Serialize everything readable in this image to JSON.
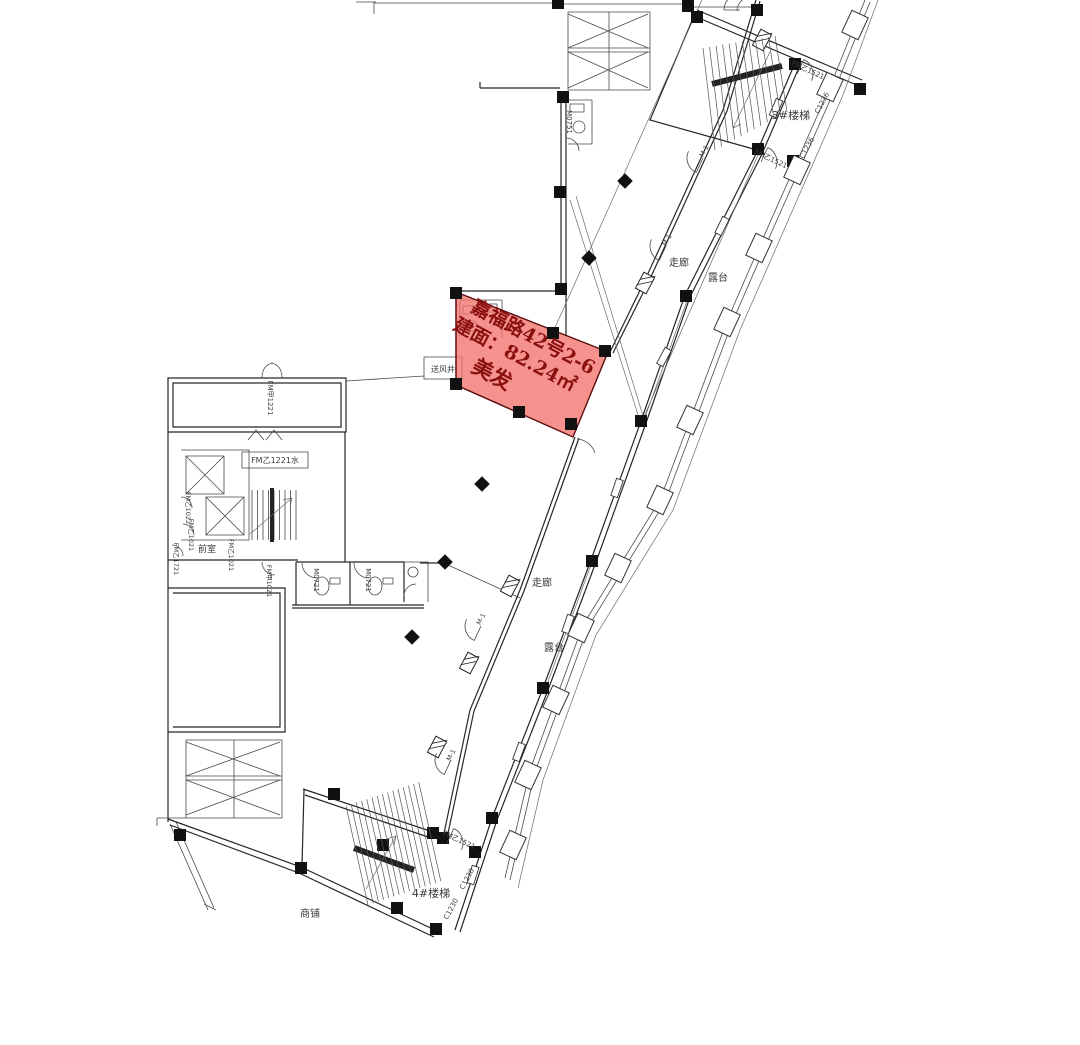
{
  "unit": {
    "address": "嘉福路42号2-6",
    "area_label": "建面：82.24㎡",
    "category": "美发",
    "fill": "#f3736e",
    "text_color": "#8a0f0f"
  },
  "labels": [
    {
      "text": "3#楼梯",
      "x": 791,
      "y": 119,
      "rot": 0,
      "size": 11
    },
    {
      "text": "4#楼梯",
      "x": 431,
      "y": 897,
      "rot": 0,
      "size": 11
    },
    {
      "text": "走廊",
      "x": 679,
      "y": 266,
      "rot": 0,
      "size": 10
    },
    {
      "text": "露台",
      "x": 718,
      "y": 281,
      "rot": 0,
      "size": 10
    },
    {
      "text": "走廊",
      "x": 542,
      "y": 586,
      "rot": 0,
      "size": 10
    },
    {
      "text": "露台",
      "x": 554,
      "y": 651,
      "rot": 0,
      "size": 10
    },
    {
      "text": "商铺",
      "x": 310,
      "y": 917,
      "rot": 0,
      "size": 10
    },
    {
      "text": "前室",
      "x": 207,
      "y": 552,
      "rot": 0,
      "size": 9
    },
    {
      "text": "送风井",
      "x": 443,
      "y": 372,
      "rot": 0,
      "size": 8
    },
    {
      "text": "FM乙1221水",
      "x": 275,
      "y": 463,
      "rot": 0,
      "size": 8
    },
    {
      "text": "FM甲1221",
      "x": 268,
      "y": 398,
      "rot": 90,
      "size": 7
    },
    {
      "text": "M0751",
      "x": 567,
      "y": 122,
      "rot": 90,
      "size": 7
    },
    {
      "text": "M0721",
      "x": 314,
      "y": 580,
      "rot": 90,
      "size": 7
    },
    {
      "text": "M0721",
      "x": 366,
      "y": 580,
      "rot": 90,
      "size": 7
    },
    {
      "text": "FM乙1022",
      "x": 186,
      "y": 508,
      "rot": 90,
      "size": 6.5
    },
    {
      "text": "FM乙1021",
      "x": 189,
      "y": 535,
      "rot": 90,
      "size": 6.5
    },
    {
      "text": "FM乙1721",
      "x": 174,
      "y": 559,
      "rot": 90,
      "size": 6.5
    },
    {
      "text": "FM乙1021",
      "x": 229,
      "y": 555,
      "rot": 90,
      "size": 6.5
    },
    {
      "text": "FM甲1021",
      "x": 267,
      "y": 581,
      "rot": 90,
      "size": 6.5
    },
    {
      "text": "FM乙1521",
      "x": 807,
      "y": 72,
      "rot": 25,
      "size": 7
    },
    {
      "text": "FM乙1521",
      "x": 770,
      "y": 161,
      "rot": 25,
      "size": 7
    },
    {
      "text": "FM乙1521",
      "x": 458,
      "y": 842,
      "rot": 25,
      "size": 7
    },
    {
      "text": "C1236",
      "x": 824,
      "y": 104,
      "rot": -62,
      "size": 7
    },
    {
      "text": "C1236",
      "x": 809,
      "y": 149,
      "rot": -62,
      "size": 7
    },
    {
      "text": "C1230",
      "x": 469,
      "y": 880,
      "rot": -62,
      "size": 7
    },
    {
      "text": "C1230",
      "x": 453,
      "y": 910,
      "rot": -62,
      "size": 7
    },
    {
      "text": "M-1",
      "x": 706,
      "y": 152,
      "rot": -62,
      "size": 6.5
    },
    {
      "text": "M-1",
      "x": 669,
      "y": 241,
      "rot": -62,
      "size": 6.5
    },
    {
      "text": "M-1",
      "x": 483,
      "y": 620,
      "rot": -62,
      "size": 6.5
    },
    {
      "text": "M-1",
      "x": 453,
      "y": 756,
      "rot": -62,
      "size": 6.5
    }
  ]
}
